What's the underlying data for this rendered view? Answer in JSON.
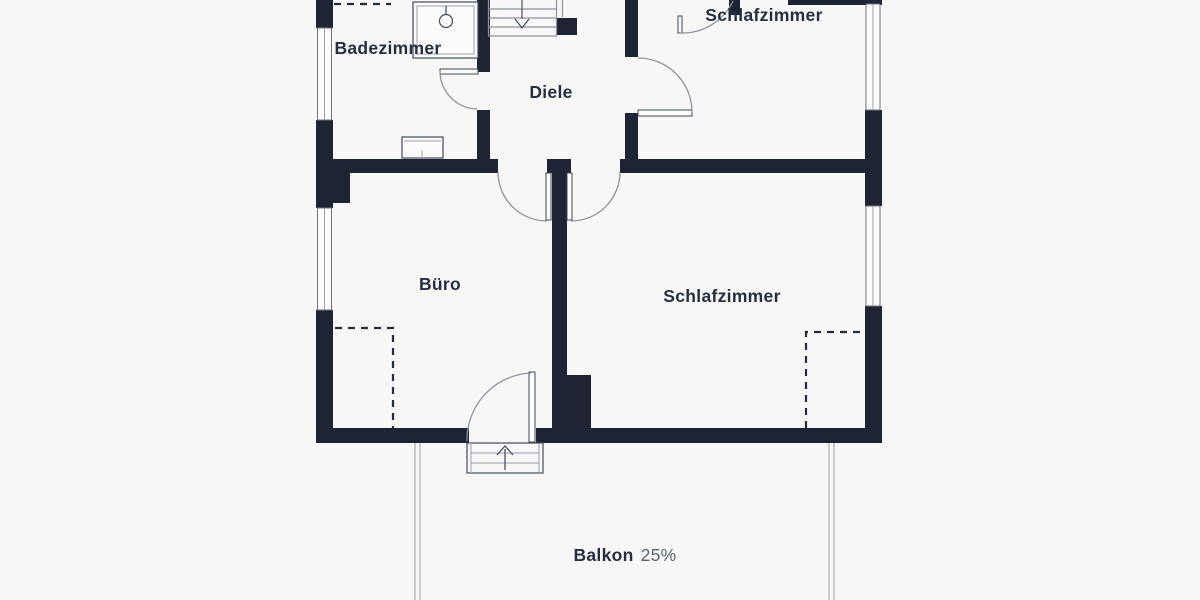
{
  "page": {
    "type": "floor-plan",
    "background": "#f7f7f8"
  },
  "colors": {
    "wall": "#1d2534",
    "label_text": "#262f40",
    "percent_text": "#5a6372",
    "door_line": "#8e939d",
    "dashed_outline": "#242d3d"
  },
  "labels": {
    "badezimmer": "Badezimmer",
    "diele": "Diele",
    "schlafzimmer_top": "Schlafzimmer",
    "buero": "Büro",
    "schlafzimmer_bottom": "Schlafzimmer",
    "balkon": "Balkon",
    "balkon_share": "25%"
  }
}
